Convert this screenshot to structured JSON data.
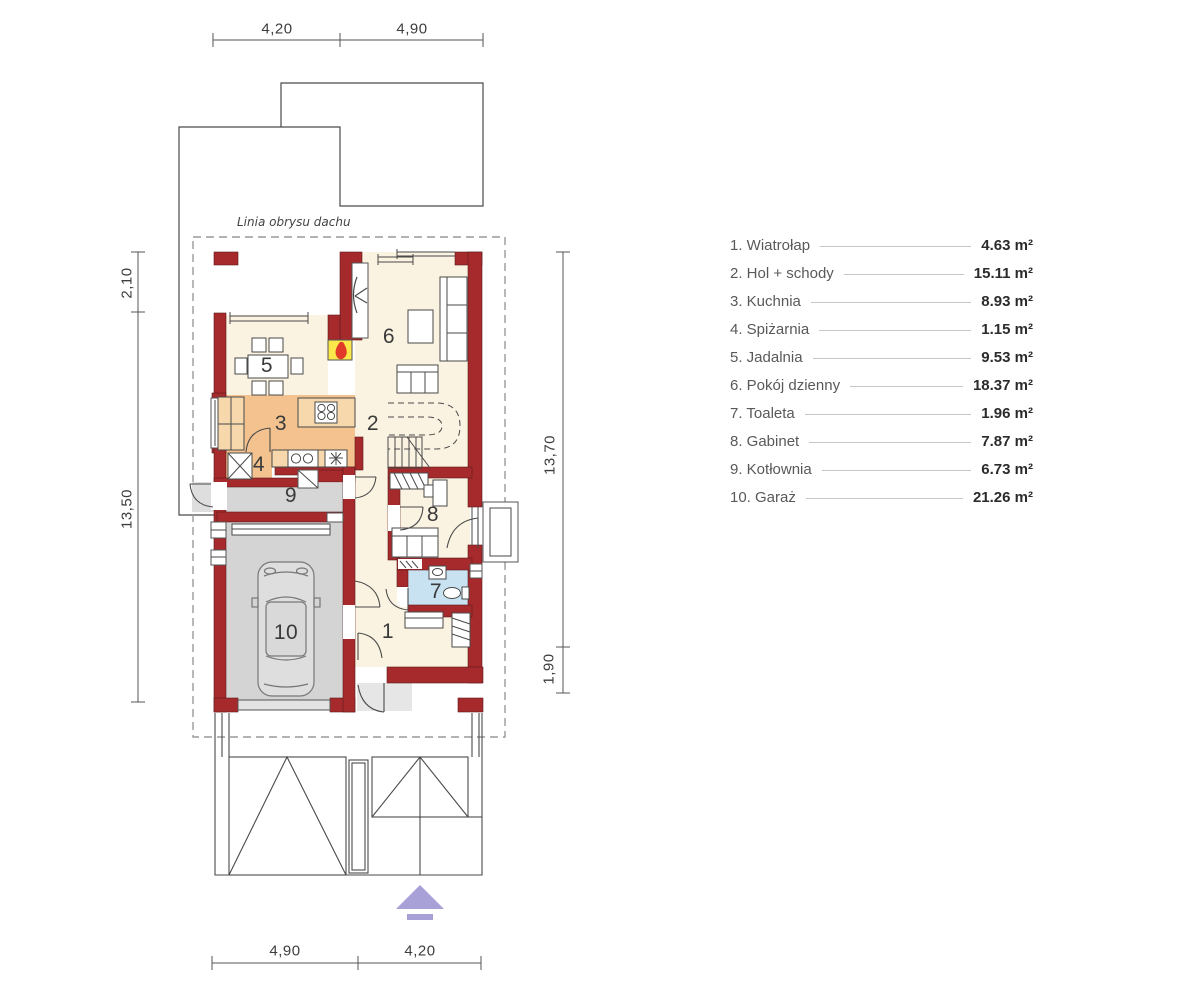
{
  "colors": {
    "wall_red": "#A6292C",
    "floor_cream": "#FAF3E1",
    "floor_orange": "#F3C28E",
    "counter_orange": "#F7D8AD",
    "floor_gray": "#D6D6D6",
    "floor_blue": "#C8E2F1",
    "fireplace_yellow": "#FCE74A",
    "flame_red": "#E23A28",
    "entrance_arrow_purple": "#A8A1D8",
    "outline_dark": "#4A4A4A",
    "dashed_gray": "#9A9A9A",
    "legend_label_gray": "#58595B",
    "legend_value_dark": "#2B2B2B"
  },
  "plan": {
    "roof_outline_label": "Linia obrysu dachu",
    "room_numbers": [
      "1",
      "2",
      "3",
      "4",
      "5",
      "6",
      "7",
      "8",
      "9",
      "10"
    ]
  },
  "dimensions": {
    "top": [
      "4,20",
      "4,90"
    ],
    "bottom": [
      "4,90",
      "4,20"
    ],
    "left": [
      "2,10",
      "13,50"
    ],
    "right": [
      "13,70",
      "1,90"
    ]
  },
  "legend": {
    "items": [
      {
        "label": "1. Wiatrołap",
        "area": "4.63 m²"
      },
      {
        "label": "2. Hol + schody",
        "area": "15.11 m²"
      },
      {
        "label": "3. Kuchnia",
        "area": "8.93 m²"
      },
      {
        "label": "4. Spiżarnia",
        "area": "1.15 m²"
      },
      {
        "label": "5. Jadalnia",
        "area": "9.53 m²"
      },
      {
        "label": "6. Pokój dzienny",
        "area": "18.37 m²"
      },
      {
        "label": "7. Toaleta",
        "area": "1.96 m²"
      },
      {
        "label": "8. Gabinet",
        "area": "7.87 m²"
      },
      {
        "label": "9. Kotłownia",
        "area": "6.73 m²"
      },
      {
        "label": "10. Garaż",
        "area": "21.26 m²"
      }
    ]
  }
}
